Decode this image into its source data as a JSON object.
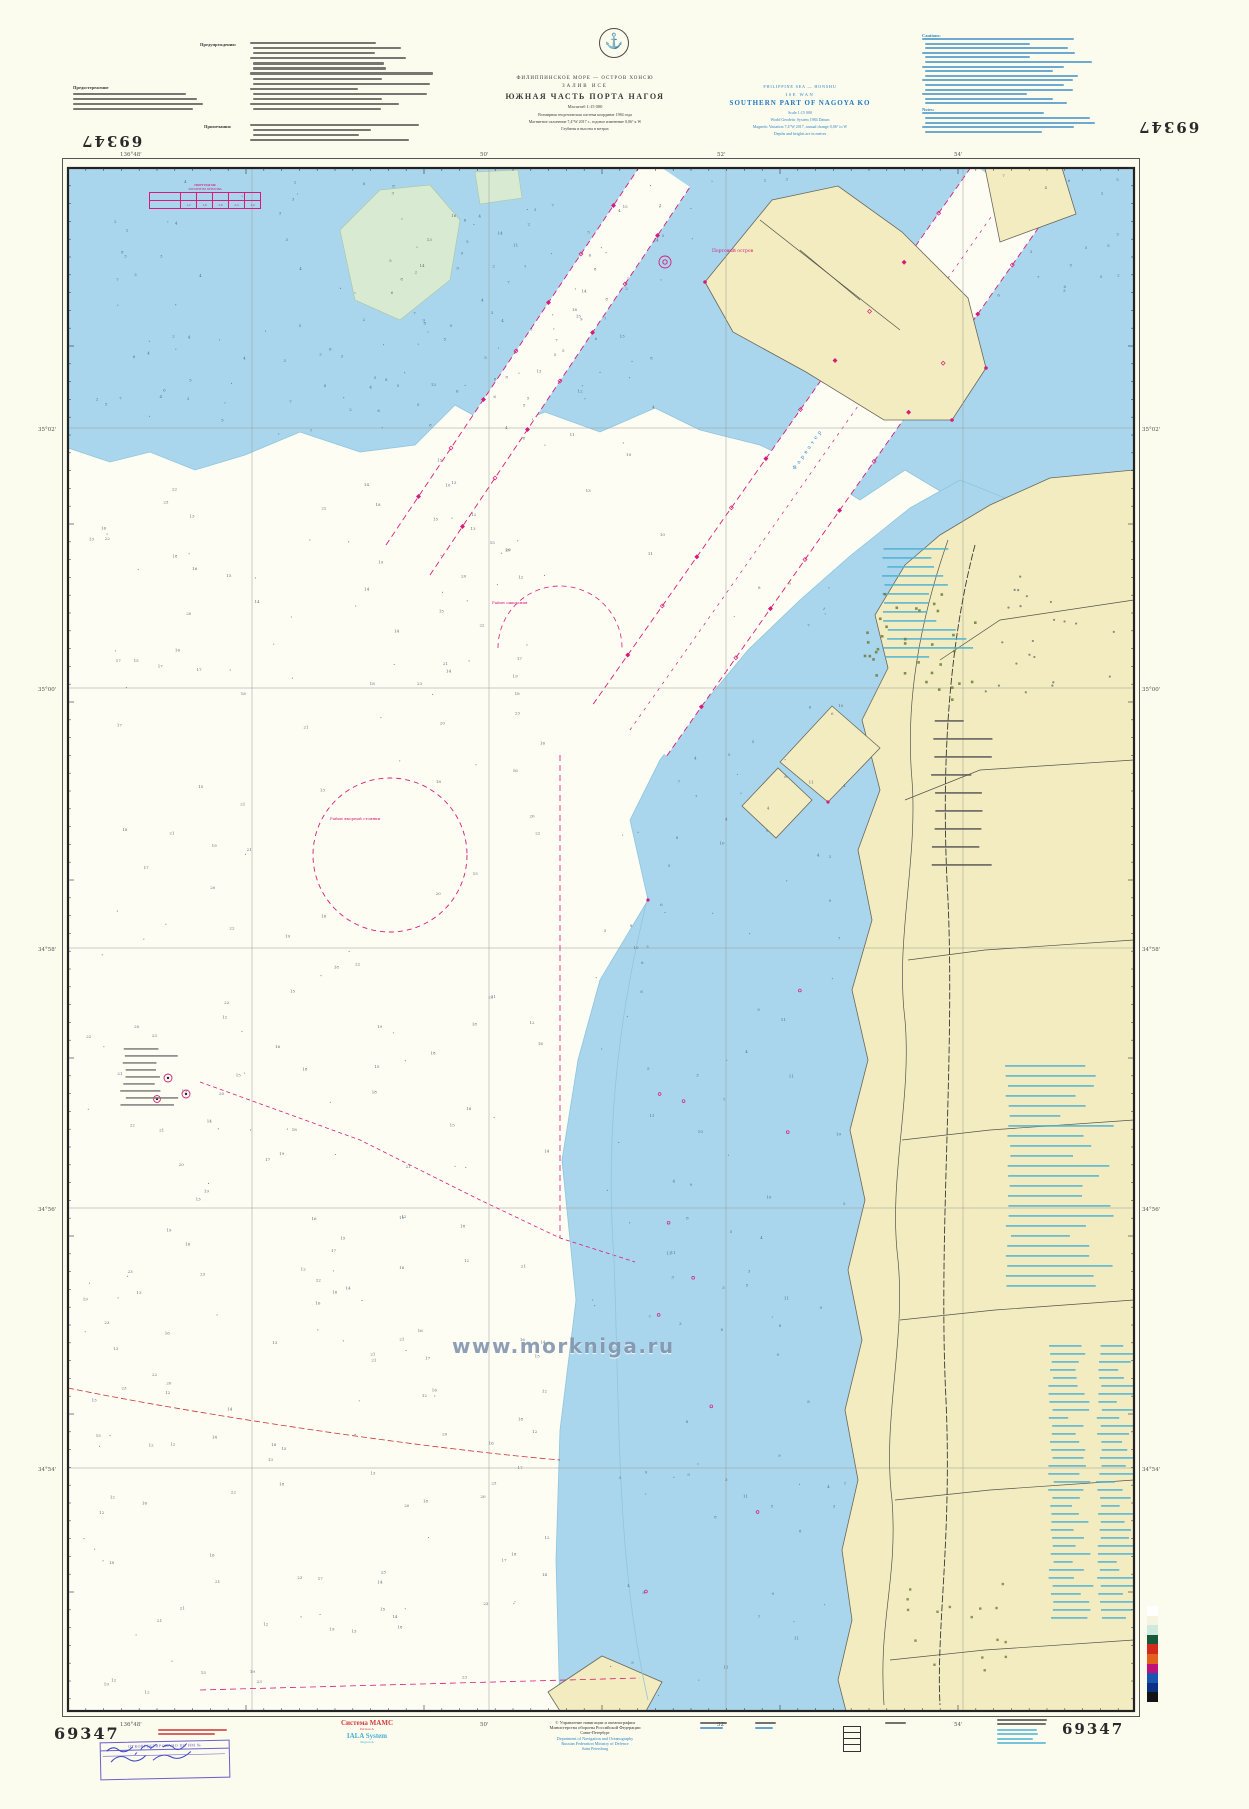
{
  "page": {
    "background": "#fbfbee"
  },
  "chart": {
    "number": "69347",
    "title_ru": {
      "lines": [
        "ФИЛИППИНСКОЕ МОРЕ — ОСТРОВ ХОНСЮ",
        "ЗАЛИВ ИСЕ",
        "ЮЖНАЯ ЧАСТЬ ПОРТА НАГОЯ",
        "Масштаб 1:15 000",
        "Всемирная геодезическая система координат 1984 года",
        "Магнитное склонение 7,4°W 2017 г., годовое изменение 0,06° к W",
        "Глубины и высоты в метрах"
      ]
    },
    "title_en": {
      "lines": [
        "PHILIPPINE SEA — HONSHU",
        "ISE WAN",
        "SOUTHERN PART OF NAGOYA KO",
        "Scale 1:15 000",
        "World Geodetic System 1984 Datum",
        "Magnetic Variation 7,4°W 2017, annual change 0,06° to W",
        "Depths and heights are in metres"
      ]
    },
    "margin_notes": {
      "caution_ru": "Предостережение",
      "warnings_ru": "Предупреждения:",
      "notes_ru": "Примечания:",
      "cautions_en": "Cautions:",
      "notes_en": "Notes:"
    },
    "tide_table": {
      "title": "ПОРТ НАГОЯ",
      "subtitle": "ЭЛЕМЕНТЫ ПРИЛИВА",
      "values": [
        "1,2",
        "1,6",
        "2,0",
        "2,4",
        "1,4"
      ]
    },
    "graticule": {
      "top": [
        "136°48'",
        "50'",
        "52'",
        "54'"
      ],
      "bottom": [
        "136°48'",
        "50'",
        "52'",
        "54'"
      ],
      "left": [
        "35°02'",
        "35°00'",
        "34°58'",
        "34°56'",
        "34°54'"
      ],
      "right": [
        "35°02'",
        "35°00'",
        "34°58'",
        "34°56'",
        "34°54'"
      ]
    },
    "map_labels": {
      "port_island": "Портовый остров",
      "waiting_area": "Район ожидания",
      "anchorage": "Район якорной стоянки",
      "fairway": "Фарватер"
    },
    "watermark": "www.morkniga.ru"
  },
  "footer": {
    "stamp_title": "ОТКОРРЕКТИРОВАНО ПО ИМ №",
    "iala_ru": "Система МАМС",
    "iala_ru_sub": "Регион А",
    "iala_en": "IALA System",
    "iala_en_sub": "Region A",
    "imprint_ru": [
      "© Управление навигации и океанографии",
      "Министерства обороны Российской Федерации",
      "Санкт-Петербург"
    ],
    "imprint_en": [
      "Department of Navigation and Oceanography",
      "Russian Federation Ministry of Defence",
      "Saint Petersburg"
    ]
  },
  "colors": {
    "water_shallow": "#a9d6ec",
    "deep_water": "#fdfdf4",
    "land": "#f2ecc0",
    "green_shoal": "#d9ead2",
    "magenta": "#d81b7a",
    "blue_text": "#2f86c8",
    "cyan_text": "#49b0d4",
    "red_text": "#cc3333"
  },
  "colorbar": [
    "#ffffff",
    "#f6f4e0",
    "#cdeadd",
    "#175a3a",
    "#d22b1e",
    "#e2621b",
    "#c0107e",
    "#1a53b0",
    "#0c2f86",
    "#141414"
  ]
}
